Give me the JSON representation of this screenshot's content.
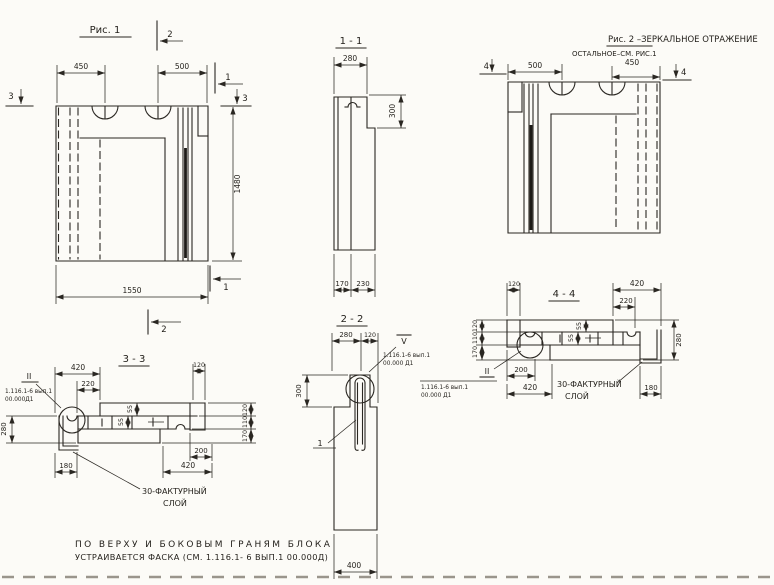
{
  "drawing": {
    "bg": "#fcfbf7",
    "ink": "#2a2722"
  },
  "fig1": {
    "title": "Рис. 1",
    "dim_450": "450",
    "dim_500": "500",
    "dim_1550": "1550",
    "dim_1480": "1480",
    "marker_top_2": "2",
    "marker_left_3": "3",
    "marker_right_1": "1",
    "marker_right_3": "3",
    "marker_bottom_1": "1",
    "marker_bottom_2": "2"
  },
  "sec11": {
    "title": "1 - 1",
    "dim_280": "280",
    "dim_300": "300",
    "dim_170": "170",
    "dim_230": "230"
  },
  "fig2": {
    "title": "Рис. 2 –ЗЕРКАЛЬНОЕ ОТРАЖЕНИЕ",
    "subtitle": "ОСТАЛЬНОЕ–СМ. РИС.1",
    "dim_500": "500",
    "dim_450": "450",
    "marker_left_4": "4",
    "marker_right_4": "4"
  },
  "sec33": {
    "title": "3 - 3",
    "dims": {
      "top_420": "420",
      "top_220": "220",
      "top_120": "120",
      "left_280": "280",
      "right_120": "120",
      "right_110": "110",
      "right_170": "170",
      "bottom_180": "180",
      "bottom_200": "200",
      "bottom_420": "420",
      "d55a": "55",
      "d55b": "55"
    },
    "detail_marker": "II",
    "ref_line1": "1.116.1-6 вып.1",
    "ref_line2": "00.000Д1",
    "layer_line1": "30-ФАКТУРНЫЙ",
    "layer_line2": "СЛОЙ"
  },
  "sec22": {
    "title": "2 - 2",
    "dims": {
      "top_280": "280",
      "top_120": "120",
      "left_300": "300",
      "bottom_400": "400"
    },
    "detail_marker": "V",
    "pos_label": "1",
    "ref_line1": "1.116.1-6 вып.1",
    "ref_line2": "00.000 Д1"
  },
  "sec44": {
    "title": "4 - 4",
    "dims": {
      "top_120": "120",
      "top_420": "420",
      "top_220": "220",
      "right_280": "280",
      "left_120": "120",
      "left_110": "110",
      "left_170": "170",
      "bottom_200": "200",
      "bottom_420": "420",
      "bottom_180": "180",
      "d55a": "55",
      "d55b": "55"
    },
    "detail_marker": "II",
    "ref_line1": "1.116.1-6 вып.1",
    "ref_line2": "00.000 Д1",
    "layer_line1": "30-ФАКТУРНЫЙ",
    "layer_line2": "СЛОЙ"
  },
  "note": {
    "line1": "ПО ВЕРХУ И БОКОВЫМ ГРАНЯМ БЛОКА",
    "line2": "УСТРАИВАЕТСЯ ФАСКА (СМ. 1.116.1- 6 ВЫП.1 00.000Д)"
  }
}
